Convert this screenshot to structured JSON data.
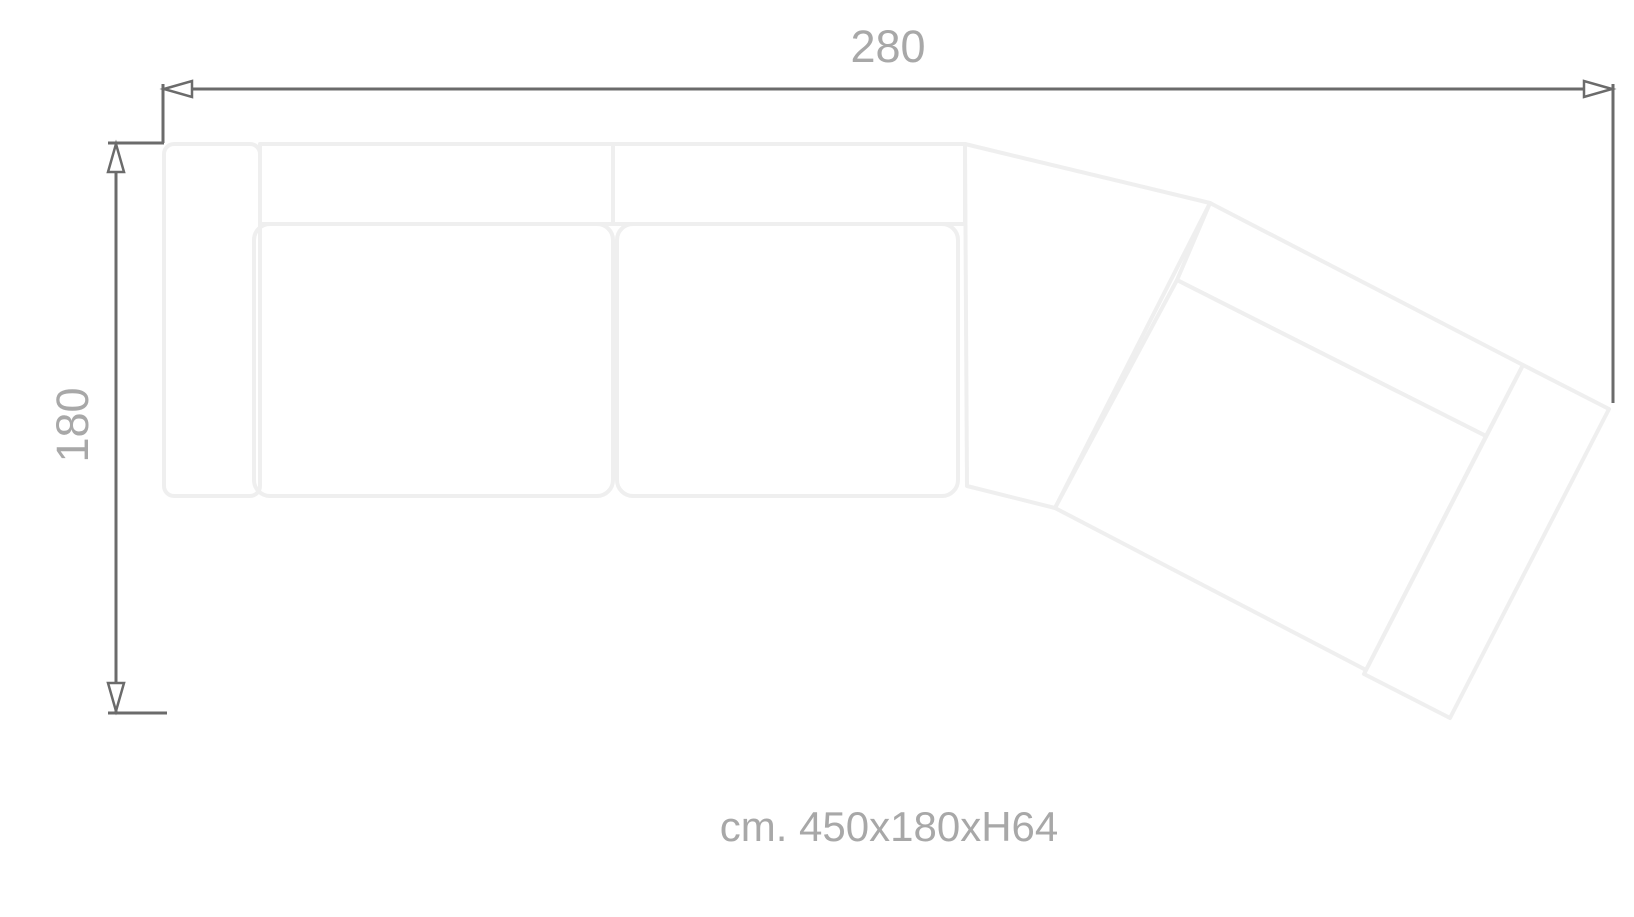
{
  "diagram": {
    "type": "sofa-top-view-dimension-drawing",
    "width_label": "280",
    "depth_label": "180",
    "size_caption": "cm. 450x180xH64"
  },
  "colors": {
    "background": "#ffffff",
    "dimension_line": "#6b6b6b",
    "label_text": "#a8a8a8",
    "sofa_outline": "#efefef"
  }
}
